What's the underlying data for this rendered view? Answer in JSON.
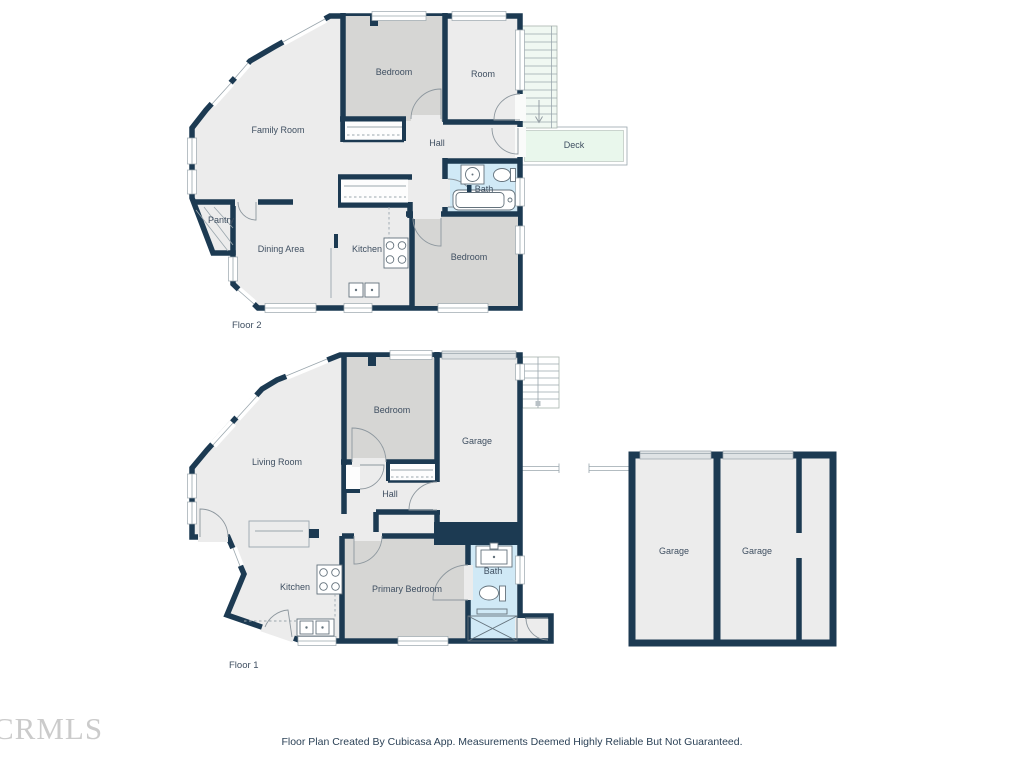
{
  "page": {
    "footer": "Floor Plan Created By Cubicasa App. Measurements Deemed Highly Reliable But Not Guaranteed.",
    "watermark": "CRMLS"
  },
  "colors": {
    "wall": "#1c3a52",
    "room": "#ececec",
    "bedroom": "#d6d6d4",
    "bath": "#d0e9f6",
    "deck": "#e9f7ec",
    "stairs": "#f0f8f2",
    "gdoor": "#dfe3e5",
    "line": "#9aa6ad",
    "label": "#3f4f61",
    "footer": "#2c4257",
    "watermark": "#cbcbcb"
  },
  "floor2": {
    "label": "Floor 2",
    "rooms": {
      "family_room": "Family Room",
      "bedroom_top": "Bedroom",
      "room": "Room",
      "hall": "Hall",
      "deck": "Deck",
      "bath": "Bath",
      "pantry": "Pantry",
      "dining_area": "Dining Area",
      "kitchen": "Kitchen",
      "bedroom_bottom": "Bedroom"
    }
  },
  "floor1": {
    "label": "Floor 1",
    "rooms": {
      "living_room": "Living Room",
      "bedroom": "Bedroom",
      "garage": "Garage",
      "hall": "Hall",
      "kitchen": "Kitchen",
      "primary_bedroom": "Primary Bedroom",
      "bath": "Bath"
    }
  },
  "garage_building": {
    "garage_left": "Garage",
    "garage_right": "Garage"
  }
}
